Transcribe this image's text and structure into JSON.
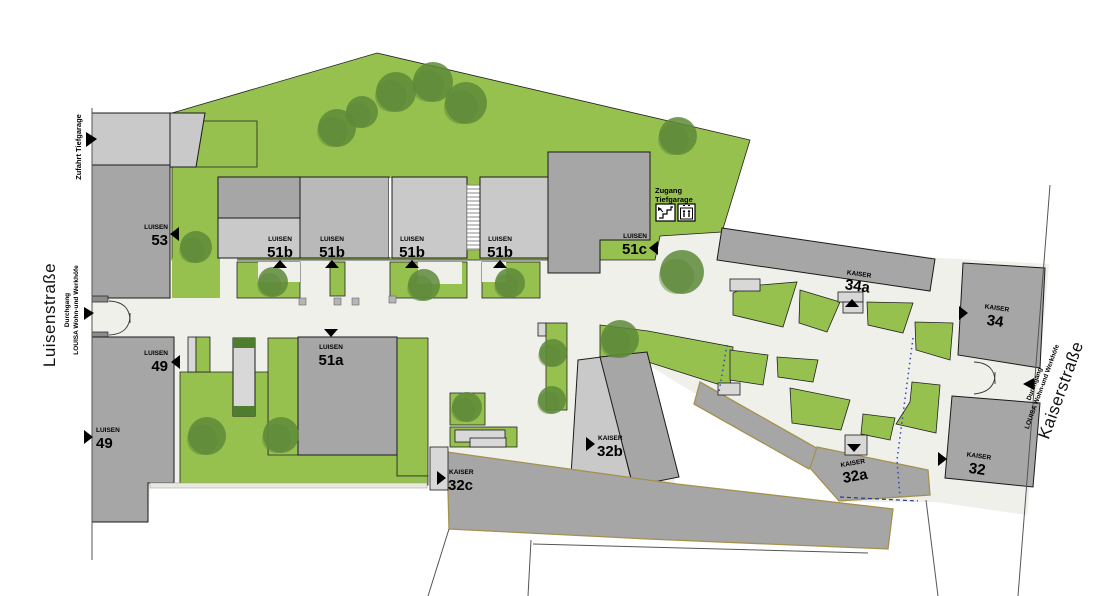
{
  "colors": {
    "green": "#97c14e",
    "green_dark": "#4e7d2f",
    "tree": "#5d8a3a",
    "building": "#a6a6a6",
    "building_light": "#c9c9c9",
    "building_lighter": "#d8d8d8",
    "path": "#f0f0eb",
    "parcel_outline": "#a5914e",
    "boundary": "#555555",
    "dotted_blue": "#3344bb",
    "dashed_blue": "#223a8c"
  },
  "streets": {
    "left": {
      "name": "Luisenstraße"
    },
    "right": {
      "name": "Kaiserstraße"
    }
  },
  "passage_left": {
    "line1": "Durchgang",
    "line2": "LOUISA Wohn-und Werkhöfe"
  },
  "passage_right": {
    "line1": "Durchgang",
    "line2": "LOUISA Wohn-und Werkhöfe"
  },
  "garage": {
    "access_label": "Zufahrt Tiefgarage",
    "entry_line1": "Zugang",
    "entry_line2": "Tiefgarage"
  },
  "buildings": {
    "luisen_53": {
      "prefix": "LUISEN",
      "number": "53"
    },
    "luisen_51a": {
      "prefix": "LUISEN",
      "number": "51a"
    },
    "luisen_51b": {
      "prefix": "LUISEN",
      "number": "51b"
    },
    "luisen_51c": {
      "prefix": "LUISEN",
      "number": "51c"
    },
    "luisen_49": {
      "prefix": "LUISEN",
      "number": "49"
    },
    "kaiser_34a": {
      "prefix": "KAISER",
      "number": "34a"
    },
    "kaiser_34": {
      "prefix": "KAISER",
      "number": "34"
    },
    "kaiser_32": {
      "prefix": "KAISER",
      "number": "32"
    },
    "kaiser_32a": {
      "prefix": "KAISER",
      "number": "32a"
    },
    "kaiser_32b": {
      "prefix": "KAISER",
      "number": "32b"
    },
    "kaiser_32c": {
      "prefix": "KAISER",
      "number": "32c"
    }
  },
  "icons": {
    "stairs": "stairs-icon",
    "elevator": "elevator-icon"
  },
  "trees": [
    [
      337,
      128,
      19
    ],
    [
      362,
      112,
      16
    ],
    [
      396,
      92,
      20
    ],
    [
      433,
      82,
      20
    ],
    [
      466,
      103,
      21
    ],
    [
      678,
      136,
      19
    ],
    [
      682,
      272,
      22
    ],
    [
      620,
      339,
      19
    ],
    [
      553,
      353,
      14
    ],
    [
      552,
      400,
      14
    ],
    [
      467,
      407,
      15
    ],
    [
      196,
      247,
      16
    ],
    [
      273,
      282,
      15
    ],
    [
      424,
      285,
      16
    ],
    [
      510,
      283,
      15
    ],
    [
      207,
      436,
      19
    ],
    [
      281,
      435,
      18
    ]
  ]
}
